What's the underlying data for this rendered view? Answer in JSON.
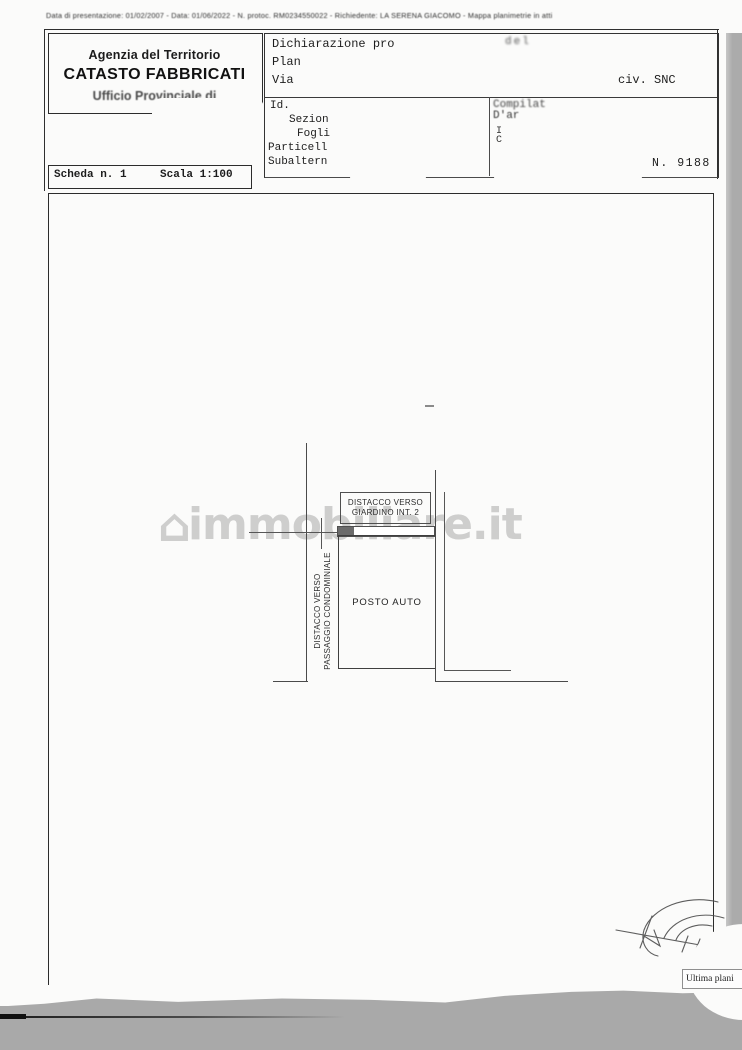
{
  "scan_header": {
    "filing_line": "Data di presentazione: 01/02/2007 - Data: 01/06/2022 - N. protoc. RM0234550022 - Richiedente: LA SERENA GIACOMO - Mappa planimetrie in atti"
  },
  "header_box": {
    "agency": "Agenzia del Territorio",
    "title": "CATASTO FABBRICATI",
    "office": "Ufficio Provinciale di"
  },
  "declaration_box": {
    "row1_label": "Dichiarazione pro",
    "row1_smudge": "del",
    "row2_label": "Plan",
    "row3_label": "Via",
    "civic": "civ. SNC"
  },
  "cadastral_box": {
    "id_label": "Id.",
    "sezione_label": "Sezion",
    "foglio_label": "Fogli",
    "particella_label": "Particell",
    "subalterno_label": "Subaltern",
    "compiler_line1": "Compilat",
    "compiler_line2": "D'ar",
    "note_line1": "I",
    "note_line2": "C",
    "sheet_number": "N. 9188"
  },
  "scheda_box": {
    "scheda": "Scheda n. 1",
    "scala": "Scala 1:100"
  },
  "plan": {
    "giardino_label_line1": "DISTACCO VERSO",
    "giardino_label_line2": "GIARDINO INT. 2",
    "room_label": "POSTO AUTO",
    "passaggio_label_line1": "DISTACCO VERSO",
    "passaggio_label_line2": "PASSAGGIO CONDOMINIALE"
  },
  "watermark": {
    "icon_glyph": "⌂",
    "text": "immobiliare.it"
  },
  "stamp": {
    "text": "Ultima plani"
  },
  "colors": {
    "scan_background": "#a9a9a9",
    "page": "#fbfbfa",
    "ink": "#1d1d1d",
    "plan_line": "#4a4a4a",
    "watermark": "#c3c3c3"
  }
}
